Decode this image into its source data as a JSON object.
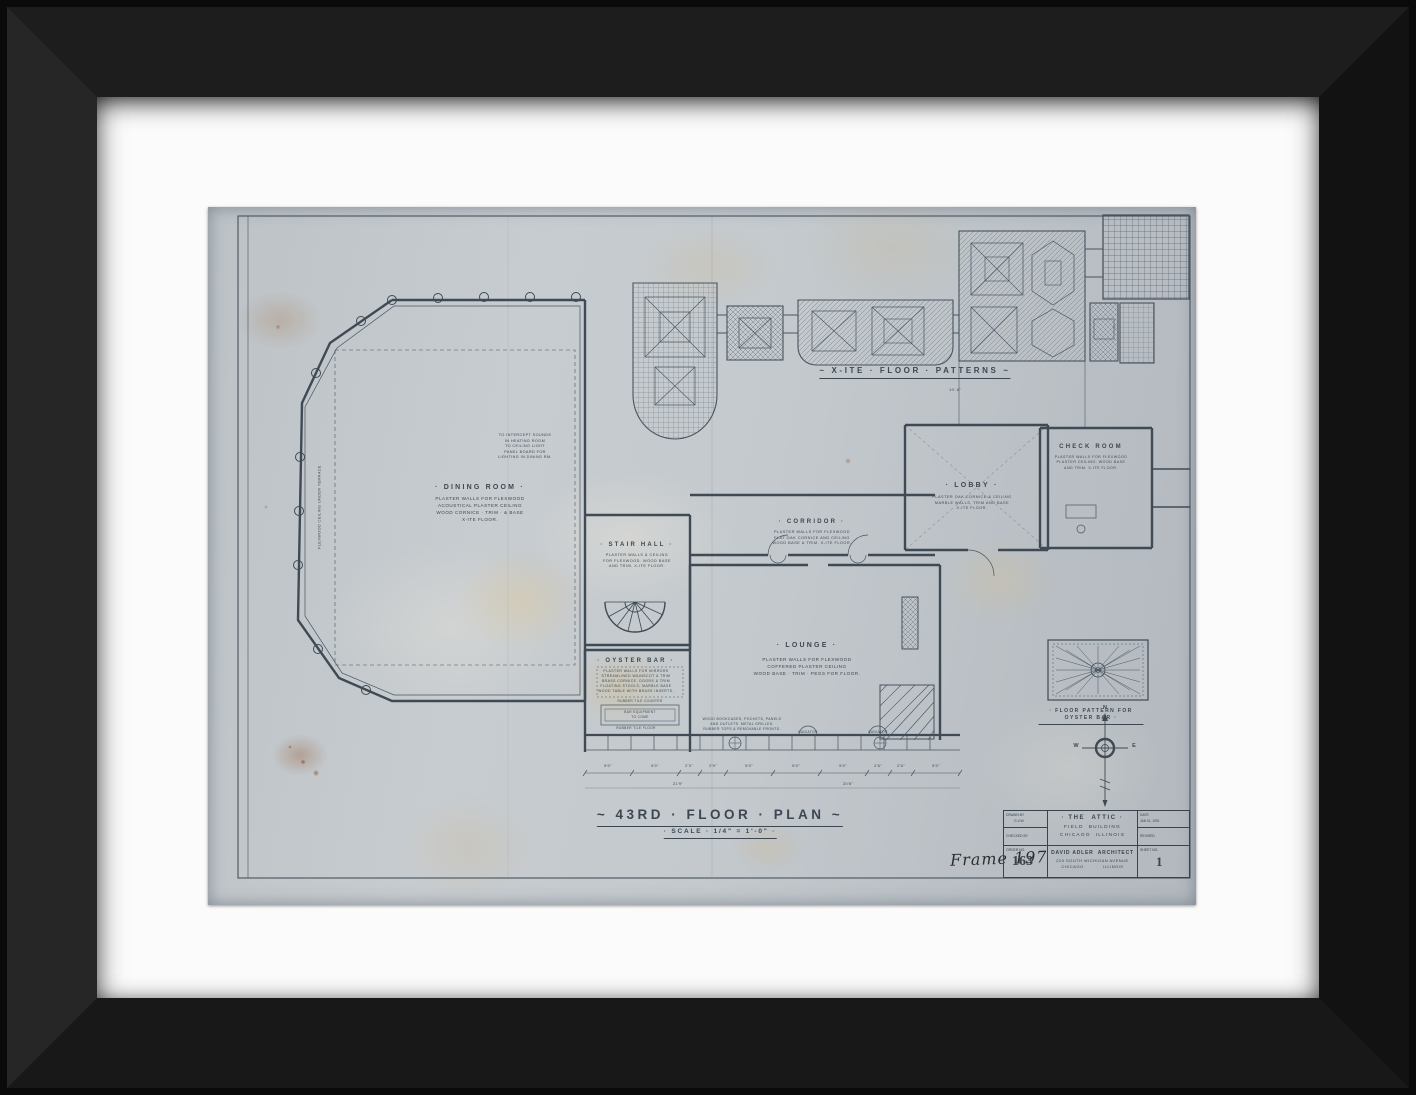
{
  "sheet": {
    "patterns_caption": "~ X-ITE · FLOOR · PATTERNS ~",
    "patterns_dim": "19'-6\"",
    "title": "~ 43RD · FLOOR · PLAN ~",
    "scale": "· SCALE · 1/4\" = 1'-0\" ·",
    "rooms": {
      "dining": {
        "name": "· DINING ROOM ·",
        "note": "PLASTER WALLS FOR FLEXWOOD\nACOUSTICAL PLASTER CEILING\nWOOD CORNICE · TRIM · & BASE\nX-ITE FLOOR."
      },
      "stair": {
        "name": "· STAIR HALL ·",
        "note": "PLASTER WALLS & CEILING\nFOR FLEXWOOD. WOOD BASE\nAND TRIM. X-ITE FLOOR."
      },
      "corridor": {
        "name": "· CORRIDOR ·",
        "note": "PLASTER WALLS FOR FLEXWOOD\nFLAT OAK CORNICE AND CEILING\nWOOD BASE & TRIM. X-ITE FLOOR."
      },
      "lobby": {
        "name": "· LOBBY ·",
        "note": "PLASTER OAK CORNICE & CEILING\nMARBLE WALLS, TRIM AND BASE\nX-ITE FLOOR."
      },
      "check": {
        "name": "CHECK ROOM",
        "note": "PLASTER WALLS FOR FLEXWOOD\nPLASTER CEILING. WOOD BASE\nAND TRIM. X-ITE FLOOR."
      },
      "lounge": {
        "name": "· LOUNGE ·",
        "note": "PLASTER WALLS FOR FLEXWOOD\nCOFFERED PLASTER CEILING\nWOOD BASE · TRIM · PEGS FOR FLOOR."
      },
      "oyster": {
        "name": "· OYSTER BAR ·",
        "note": "PLASTER WALLS FOR MIRRORS\nSTREAMLINED WAINSCOT & TRIM\nBRASS CORNICE, DOORS & TRIM\nFLOATING STOOLS, MARBLE BASE\nWOOD TABLE WITH BRASS INSERTS."
      }
    },
    "notes": {
      "panel_board": "TO INTERCEPT SOUNDS\nIN HEATING ROOM\nTO CEILING LIGHT\nPANEL BOARD FOR\nLIGHTING IN DINING RM.",
      "terrace": "FLEXWOOD CEILING UNDER TERRACE",
      "counter": "RUBBER TILE COUNTER",
      "bar_equipment": "BAR EQUIPMENT\nTO COME",
      "tile_floor": "RUBBER TILE FLOOR",
      "bookcases": "WOOD BOOKCASES, POCKETS, PANELS\nAND OUTLETS. METAL GRILLES.\nRUBBER TOPS & REMOVABLE FRONTS.",
      "radiator1": "RADIATOR",
      "radiator2": "RADIATOR"
    },
    "oyster_inset_caption": "· FLOOR PATTERN FOR OYSTER BAR ·",
    "compass": {
      "n": "N",
      "w": "W",
      "e": "E"
    },
    "dims_bottom": [
      "5'0\"",
      "5'0\"",
      "2'3\"",
      "2'9\"",
      "5'0\"",
      "5'0\"",
      "5'0\"",
      "2'6\"",
      "2'6\"",
      "5'0\""
    ],
    "dims_totals": [
      "21'9\"",
      "20'6\""
    ],
    "handwriting": "Frame 197",
    "titleblock": {
      "drawn_by_label": "DRAWN BY",
      "drawn_by": "G.V.W.",
      "checked_by_label": "CHECKED BY",
      "order_label": "ORDER NO.",
      "order_no": "163",
      "project_line1": "· THE  ATTIC ·",
      "project_line2": "FIELD  BUILDING",
      "project_line3": "CHICAGO  ILLINOIS",
      "architect_line1": "DAVID ADLER  ARCHITECT",
      "architect_line2": "220 SOUTH MICHIGAN AVENUE",
      "architect_line3": "CHICAGO            ILLINOIS",
      "date_label": "DATE",
      "date": "JAN 31, 1933",
      "revised_label": "REVISED",
      "sheet_label": "SHEET NO.",
      "sheet_no": "1"
    }
  }
}
